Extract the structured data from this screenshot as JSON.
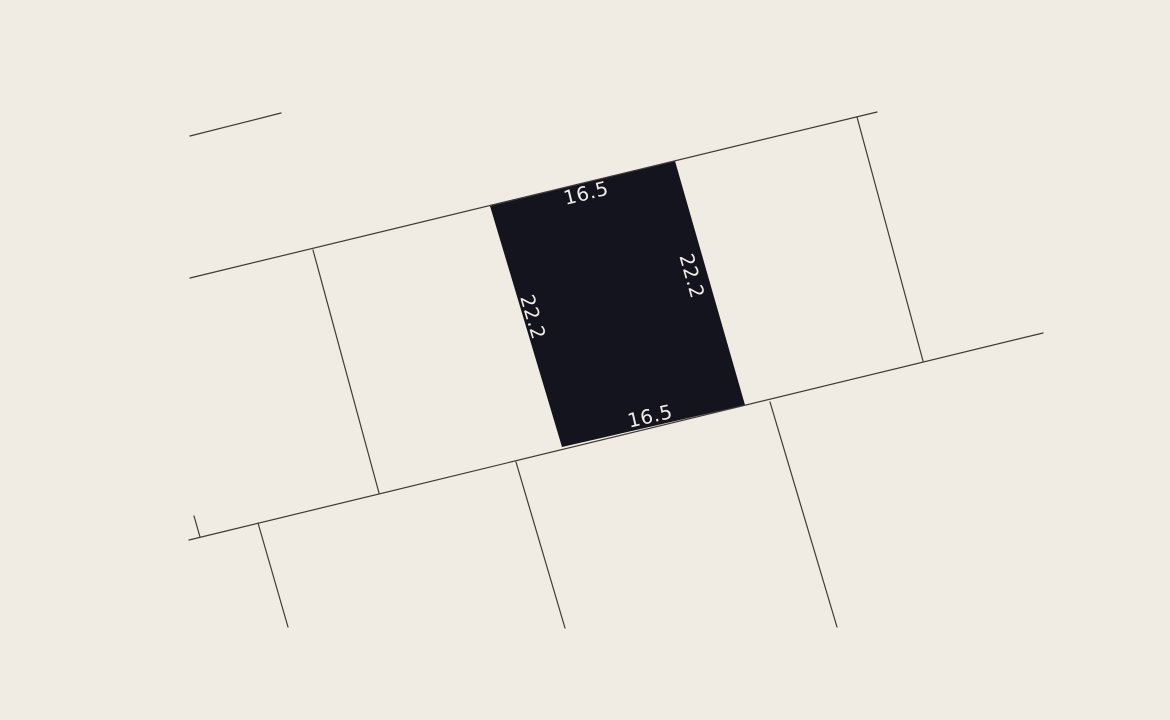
{
  "canvas": {
    "width": 1170,
    "height": 720,
    "background_color": "#f0ebe3"
  },
  "map": {
    "style": {
      "boundary_line_color": "#3e3a34",
      "boundary_line_width": 1.2,
      "parcel_fill_color": "#14141e",
      "dimension_label_color": "#f2eee6",
      "dimension_label_font_size": 19.5
    },
    "boundary_lines": [
      {
        "name": "street-edge-fragment-top-left",
        "x1": 190,
        "y1": 136,
        "x2": 281,
        "y2": 113
      },
      {
        "name": "street-edge-top",
        "x1": 190,
        "y1": 278,
        "x2": 877,
        "y2": 112
      },
      {
        "name": "street-edge-bottom",
        "x1": 189,
        "y1": 540,
        "x2": 1043,
        "y2": 333
      },
      {
        "name": "lot-divider-upper-left",
        "x1": 313,
        "y1": 250,
        "x2": 379,
        "y2": 493
      },
      {
        "name": "lot-divider-upper-right",
        "x1": 857,
        "y1": 117,
        "x2": 923,
        "y2": 361
      },
      {
        "name": "lot-divider-lower-tick",
        "x1": 194,
        "y1": 516,
        "x2": 200,
        "y2": 537
      },
      {
        "name": "lot-divider-lower-1",
        "x1": 258,
        "y1": 523,
        "x2": 288,
        "y2": 627
      },
      {
        "name": "lot-divider-lower-2",
        "x1": 516,
        "y1": 462,
        "x2": 565,
        "y2": 628
      },
      {
        "name": "lot-divider-lower-3",
        "x1": 770,
        "y1": 402,
        "x2": 837,
        "y2": 627
      }
    ],
    "highlighted_parcel": {
      "points": [
        [
          490,
          206
        ],
        [
          675,
          161
        ],
        [
          745,
          405
        ],
        [
          562,
          447
        ]
      ],
      "dimension_labels": [
        {
          "text": "16.5",
          "edge": "top",
          "x": 586,
          "y": 193,
          "rotation": -13.7
        },
        {
          "text": "22.2",
          "edge": "right",
          "x": 692,
          "y": 276,
          "rotation": 74.0
        },
        {
          "text": "22.2",
          "edge": "left",
          "x": 533,
          "y": 317,
          "rotation": 73.4
        },
        {
          "text": "16.5",
          "edge": "bottom",
          "x": 650,
          "y": 416,
          "rotation": -12.9
        }
      ]
    }
  }
}
